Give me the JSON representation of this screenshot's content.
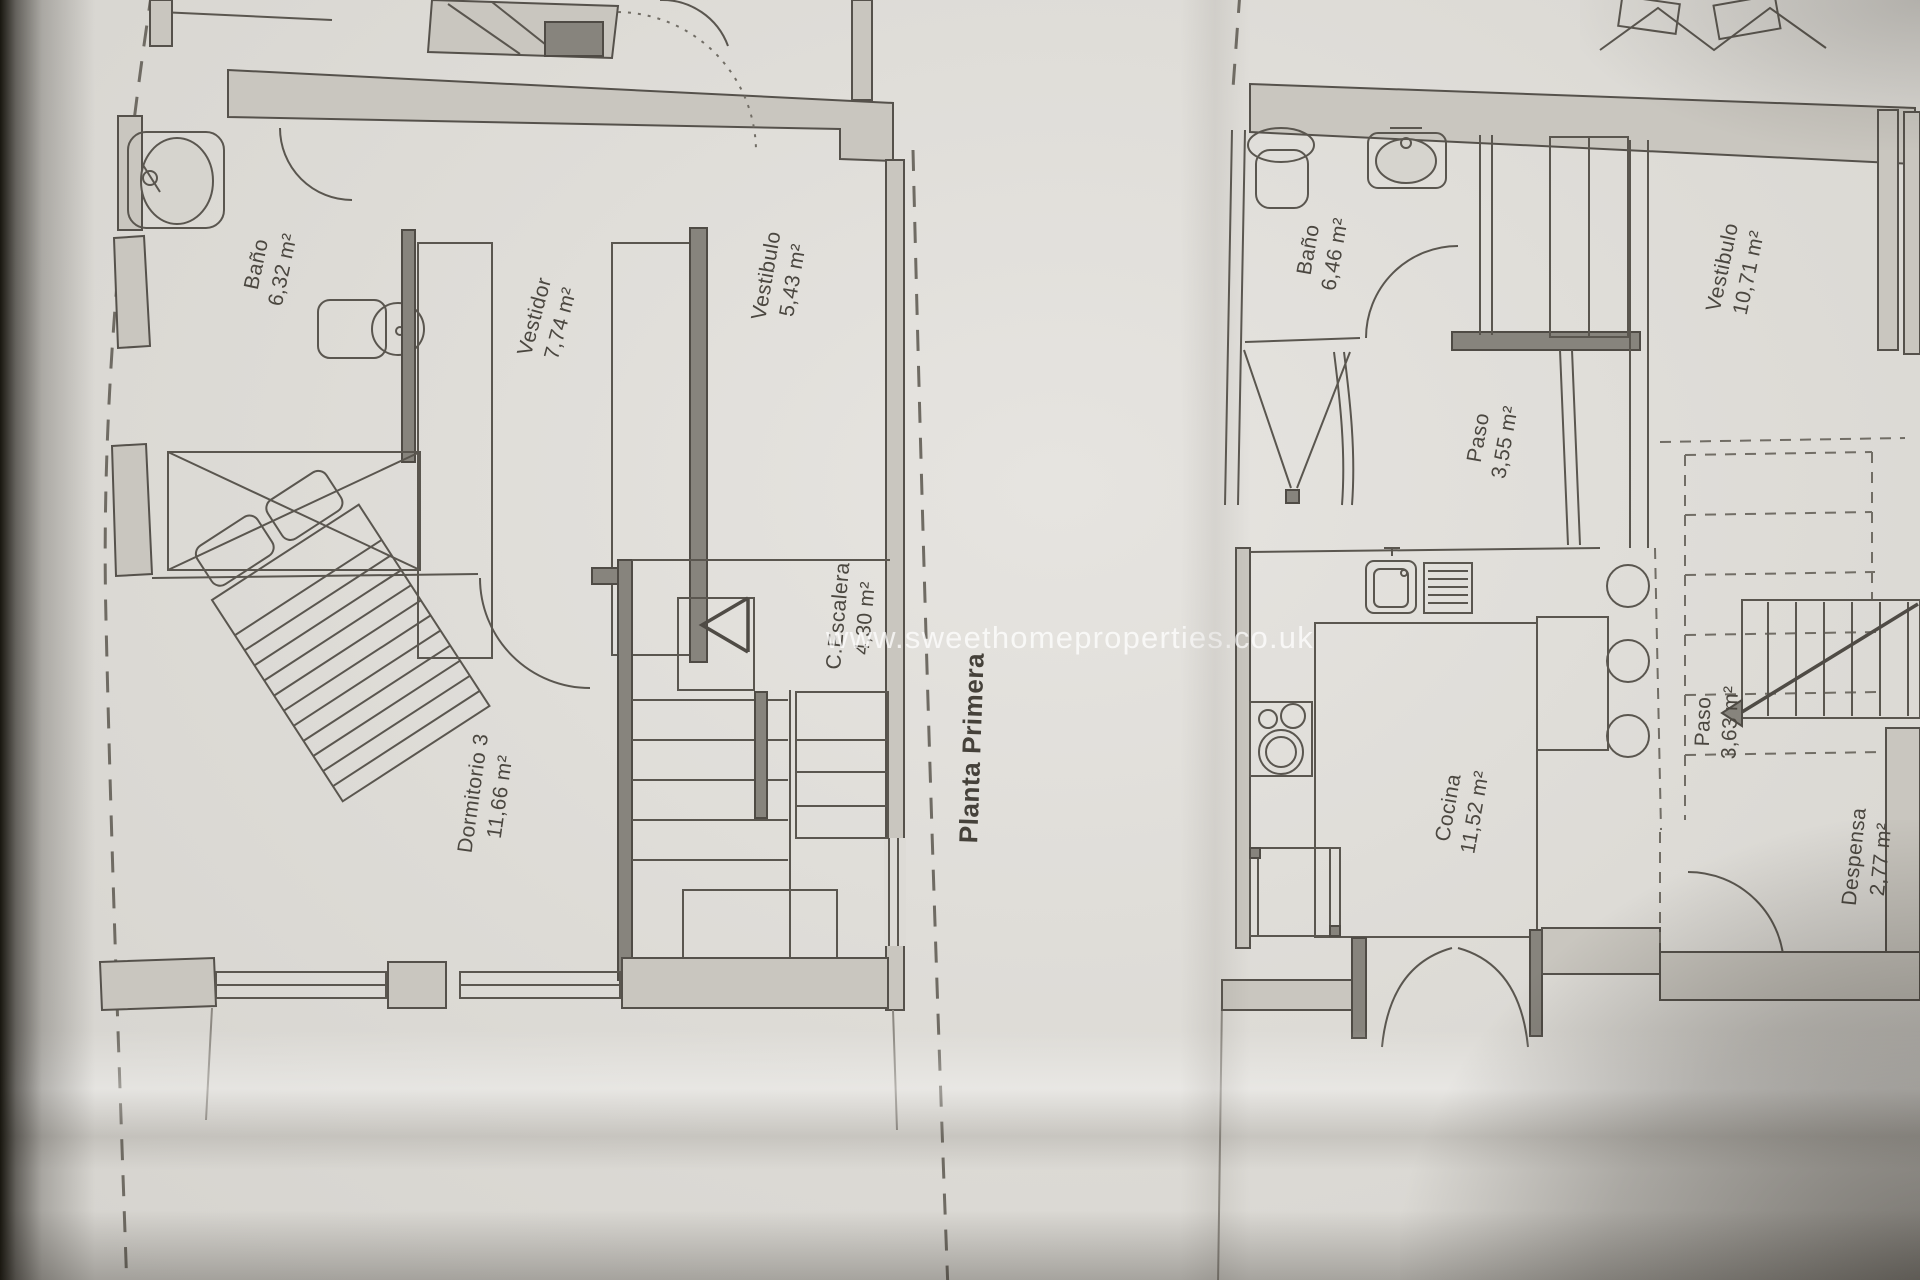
{
  "document": {
    "kind": "floor-plan-photo",
    "title": "Planta Primera",
    "watermark": "www.sweethomeproperties.co.uk"
  },
  "colors": {
    "paper": "#dddbd6",
    "line": "#5a564f",
    "wall_fill": "#c9c6bf",
    "watermark": "rgba(255,255,255,0.74)"
  },
  "labels": {
    "bano_left": {
      "name": "Baño",
      "area": "6,32 m²"
    },
    "vestidor": {
      "name": "Vestidor",
      "area": "7,74 m²"
    },
    "vestibulo_left": {
      "name": "Vestibulo",
      "area": "5,43 m²"
    },
    "escalera": {
      "name": "C.Escalera",
      "area": "4,30 m²"
    },
    "dormitorio3": {
      "name": "Dormitorio 3",
      "area": "11,66 m²"
    },
    "bano_right": {
      "name": "Baño",
      "area": "6,46 m²"
    },
    "paso_upper": {
      "name": "Paso",
      "area": "3,55 m²"
    },
    "vestibulo_right": {
      "name": "Vestibulo",
      "area": "10,71 m²"
    },
    "cocina": {
      "name": "Cocina",
      "area": "11,52 m²"
    },
    "paso_lower": {
      "name": "Paso",
      "area": "3,63 m²"
    },
    "despensa": {
      "name": "Despensa",
      "area": "2,77 m²"
    }
  }
}
